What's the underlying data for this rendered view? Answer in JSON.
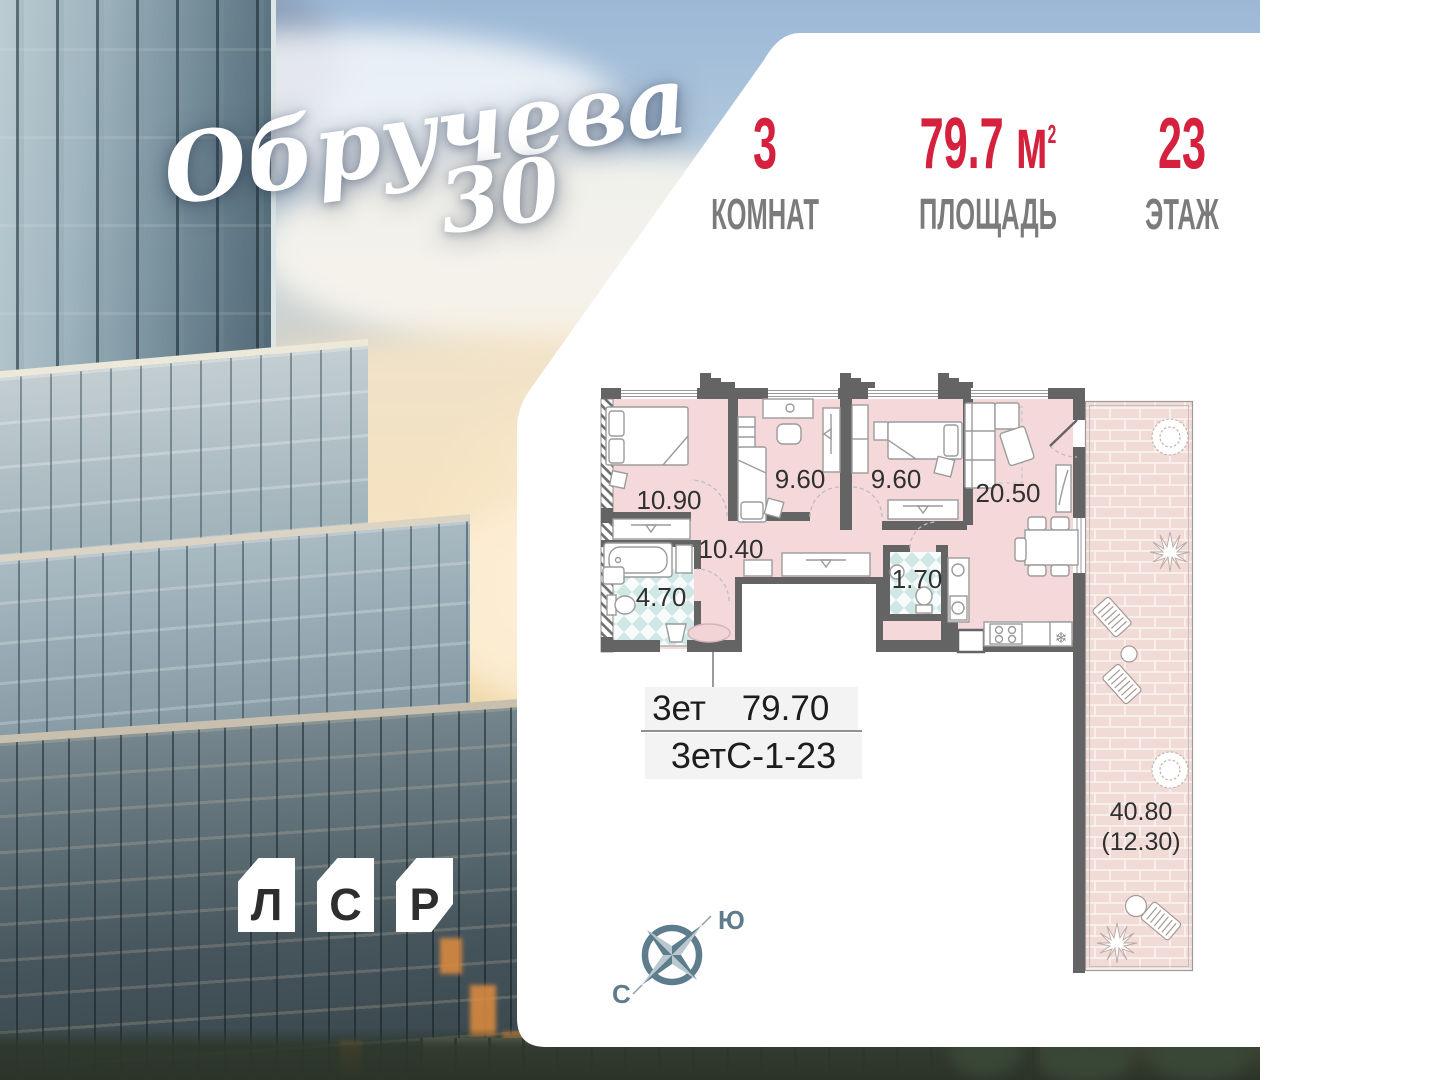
{
  "logo": {
    "name": "Обручева",
    "number": "30"
  },
  "stats": {
    "items": [
      {
        "value": "3",
        "label": "КОМНАТ"
      },
      {
        "value": "79.7",
        "unit": "м",
        "sup": "2",
        "label": "ПЛОЩАДЬ"
      },
      {
        "value": "23",
        "label": "ЭТАЖ"
      }
    ]
  },
  "plan": {
    "room_labels": [
      {
        "name": "bedroom-1",
        "area": "10.90"
      },
      {
        "name": "bedroom-2",
        "area": "9.60"
      },
      {
        "name": "bedroom-3",
        "area": "9.60"
      },
      {
        "name": "living-kitchen",
        "area": "20.50"
      },
      {
        "name": "hallway",
        "area": "10.40"
      },
      {
        "name": "bathroom",
        "area": "4.70"
      },
      {
        "name": "wc",
        "area": "1.70"
      }
    ],
    "terrace_label_line1": "40.80",
    "terrace_label_line2": "(12.30)",
    "fridge_icon": "❄"
  },
  "info_table": {
    "type": "3ет",
    "area": "79.70",
    "code": "3етС-1-23"
  },
  "compass": {
    "north": "С",
    "south": "Ю"
  },
  "developer": {
    "letters": [
      "Л",
      "С",
      "Р"
    ]
  },
  "colors": {
    "accent_red": "#d5213e",
    "wall_gray": "#646464",
    "room_pink": "#f5d9da",
    "terrace_brick": "#f1dbd7",
    "bath_teal": "#cfe7e5",
    "compass_slate": "#5e7d8c"
  }
}
